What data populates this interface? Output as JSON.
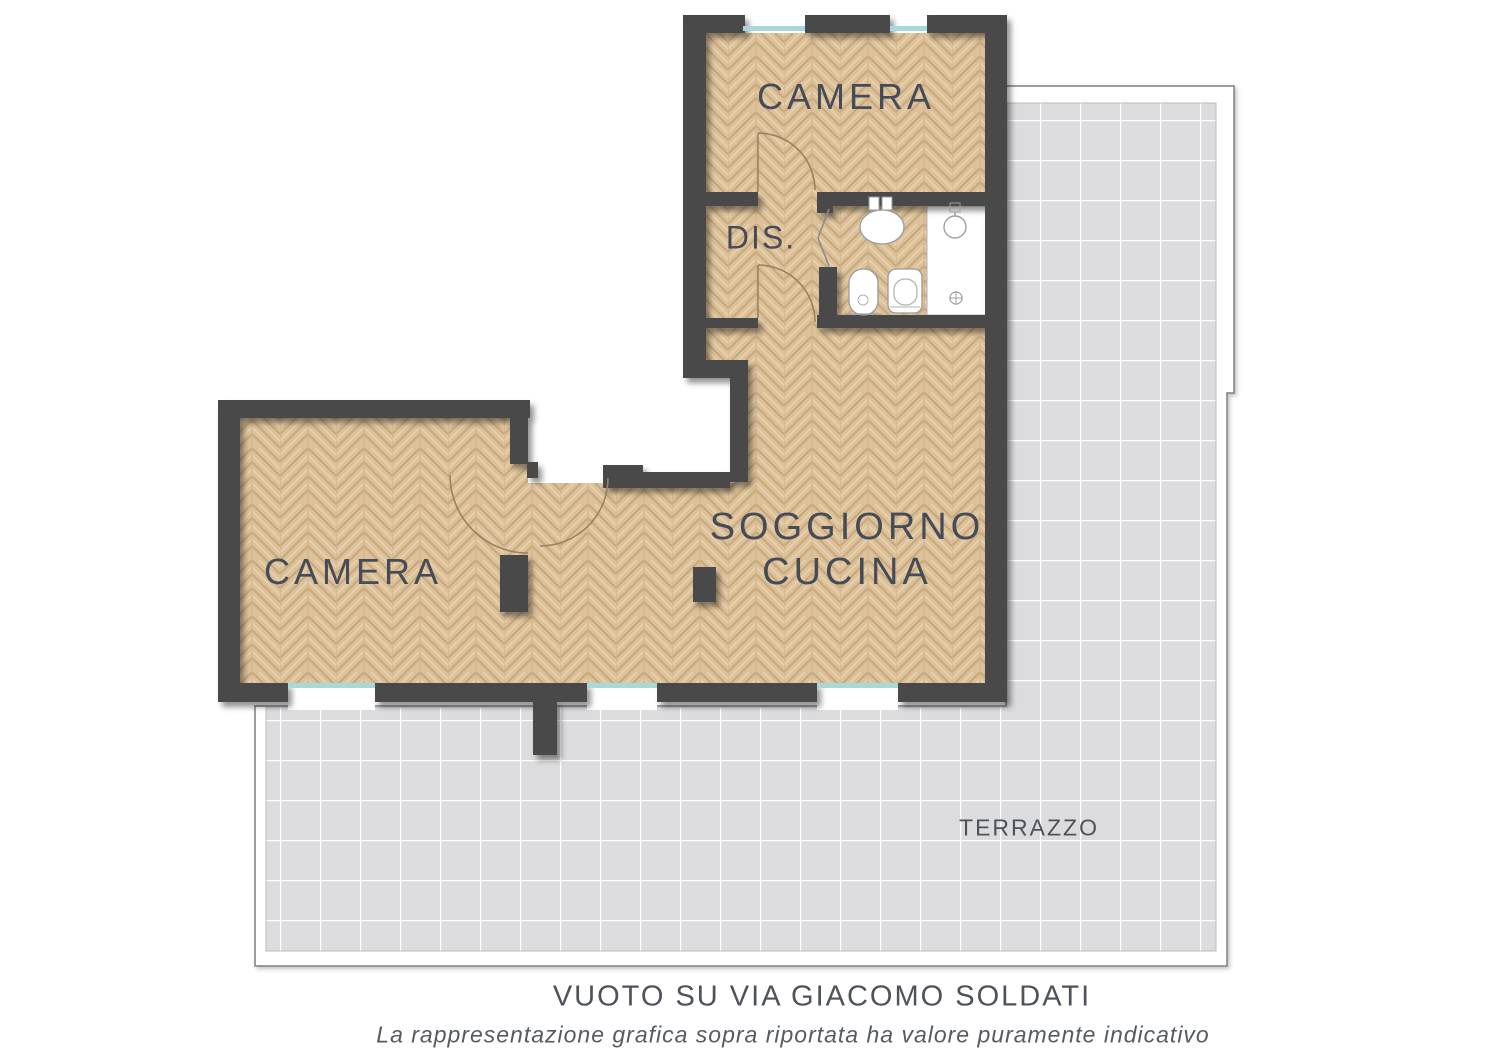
{
  "rooms": {
    "camera_top": {
      "label": "CAMERA"
    },
    "dis": {
      "label": "DIS."
    },
    "camera_left": {
      "label": "CAMERA"
    },
    "soggiorno": {
      "line1": "SOGGIORNO",
      "line2": "CUCINA"
    },
    "terrazzo": {
      "label": "TERRAZZO"
    }
  },
  "captions": {
    "street": "VUOTO SU VIA GIACOMO SOLDATI",
    "disclaimer": "La rappresentazione grafica sopra riportata ha valore puramente indicativo"
  },
  "colors": {
    "wall": "#4a4a48",
    "parquet_base": "#dcc19a",
    "parquet_grain": "#c9aa7e",
    "terrace_tile": "#dcdcde",
    "terrace_grout": "#ffffff",
    "window_glass": "#a9d7da",
    "door_arc": "#96835f",
    "label_text": "#454b57"
  }
}
